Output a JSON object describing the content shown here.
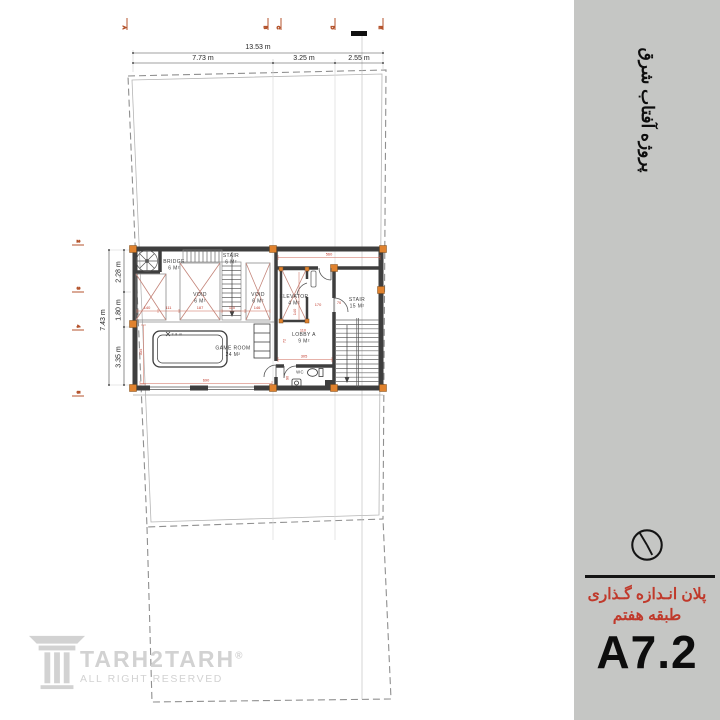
{
  "colors": {
    "sidebar_bg": "#c5c6c4",
    "wall": "#3e3e3e",
    "column_orange": "#e0822e",
    "dim_red": "#c0392b",
    "grid_marker": "#b4532c",
    "watermark_gray": "#d2d2d2"
  },
  "sidebar": {
    "project_title": "پروژه آفتاب شرق",
    "plan_title_line1": "پلان انـدازه گـذاری",
    "plan_title_line2": "طبقه هفتم",
    "sheet_number": "A7.2"
  },
  "logo": {
    "brand": "TARH2TARH",
    "registered": "®",
    "tagline": "ALL RIGHT RESERVED"
  },
  "dims": {
    "top_total": "13.53 m",
    "top_segments": [
      "7.73 m",
      "3.25 m",
      "2.55 m"
    ],
    "left_total": "7.43 m",
    "left_segments": [
      "2.28 m",
      "1.80 m",
      "3.35 m"
    ]
  },
  "grid": {
    "top_labels": [
      "A",
      "B",
      "C",
      "D",
      "E"
    ],
    "left_labels": [
      "2",
      "3",
      "4",
      "5"
    ]
  },
  "plan": {
    "rooms": [
      {
        "name": "BRIDGE",
        "area": "6 M²"
      },
      {
        "name": "STAIR",
        "area": "6 M²"
      },
      {
        "name": "VOID",
        "area": "6 M²"
      },
      {
        "name": "VOID",
        "area": "6 M²"
      },
      {
        "name": "ELEVATOR",
        "area": "4 M²"
      },
      {
        "name": "STAIR",
        "area": "15 M²"
      },
      {
        "name": "LOBBY A",
        "area": "9 M²"
      },
      {
        "name": "GAME ROOM",
        "area": "24 M²"
      },
      {
        "name": "WC",
        "area": ""
      }
    ],
    "red_dims": [
      "560",
      "140",
      "111",
      "187",
      "110",
      "146",
      "140",
      "170",
      "70",
      "110",
      "305",
      "72",
      "690",
      "335",
      "90"
    ],
    "annotations": {
      "game_marker": "3.8 m"
    }
  }
}
